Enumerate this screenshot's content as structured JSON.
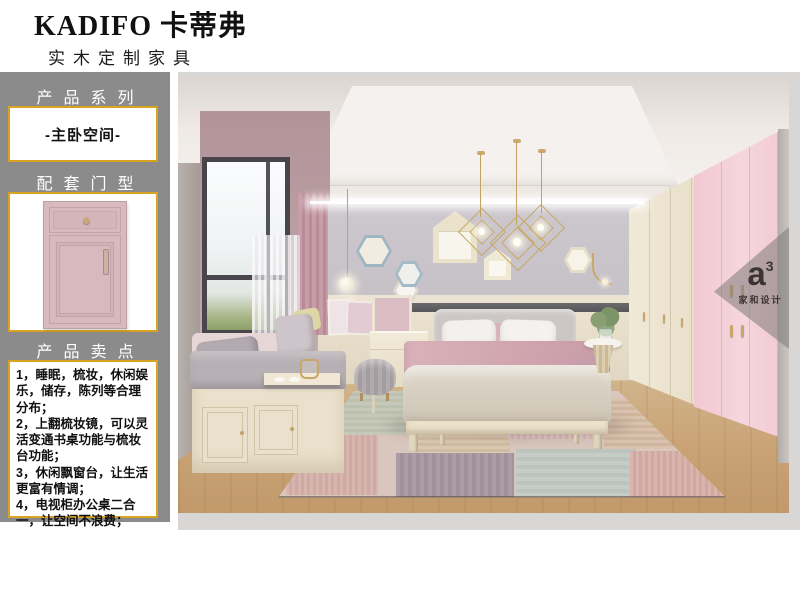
{
  "header": {
    "brand": "KADIFO 卡蒂弗",
    "subtitle": "实木定制家具"
  },
  "sidebar": {
    "bg_color": "#8b8b8b",
    "accent_border_color": "#d8a322",
    "series_label": "产品系列",
    "series_value": "-主卧空间-",
    "door_label": "配套门型",
    "selling_label": "产品卖点",
    "selling_points": [
      "1，睡眠，梳妆，休闲娱乐，储存，陈列等合理分布；",
      "2，上翻梳妆镜，可以灵活变通书桌功能与梳妆台功能；",
      "3，休闲飘窗台，让生活更富有情调；",
      "4，电视柜办公桌二合一，让空间不浪费；"
    ]
  },
  "photo": {
    "watermark": {
      "logo": "a",
      "sup": "3",
      "name": "家和设计"
    },
    "palette": {
      "wall": "#c7c3c9",
      "wainscot": "#ece4d2",
      "wardrobe_cream": "#ece4d0",
      "wardrobe_pink": "#f4cfd8",
      "curtain_pink": "#c49aa5",
      "floor_wood": "#c8a87c",
      "door_pink": "#d8babe"
    }
  }
}
